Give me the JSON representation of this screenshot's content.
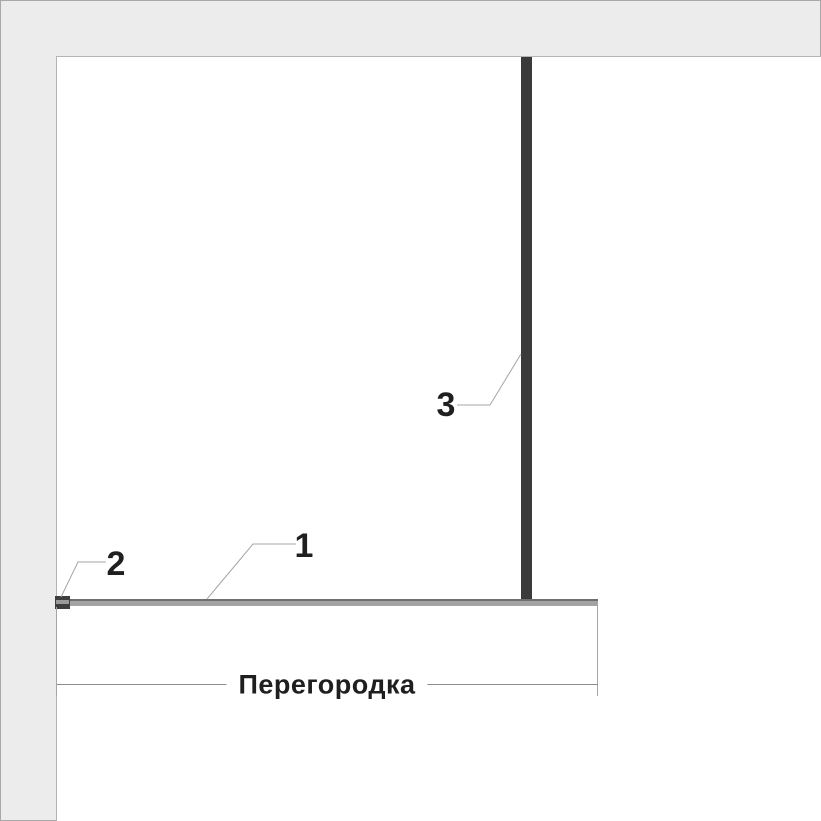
{
  "colors": {
    "page_gray": "#ececec",
    "outer_border": "#a8a8a8",
    "edge_line": "#b4b4b4",
    "stud_dark": "#3a3a3c",
    "track_fill": "#a3a3a3",
    "track_edge": "#6f6f6f",
    "cap_dark": "#3e3e3e",
    "thin_line": "#a6a6a6",
    "dim_line": "#8c8c8c",
    "label_text": "#1f1f1f"
  },
  "drawing": {
    "dimension_label": "Перегородка",
    "callouts": [
      {
        "label": "1"
      },
      {
        "label": "2"
      },
      {
        "label": "3"
      }
    ]
  }
}
